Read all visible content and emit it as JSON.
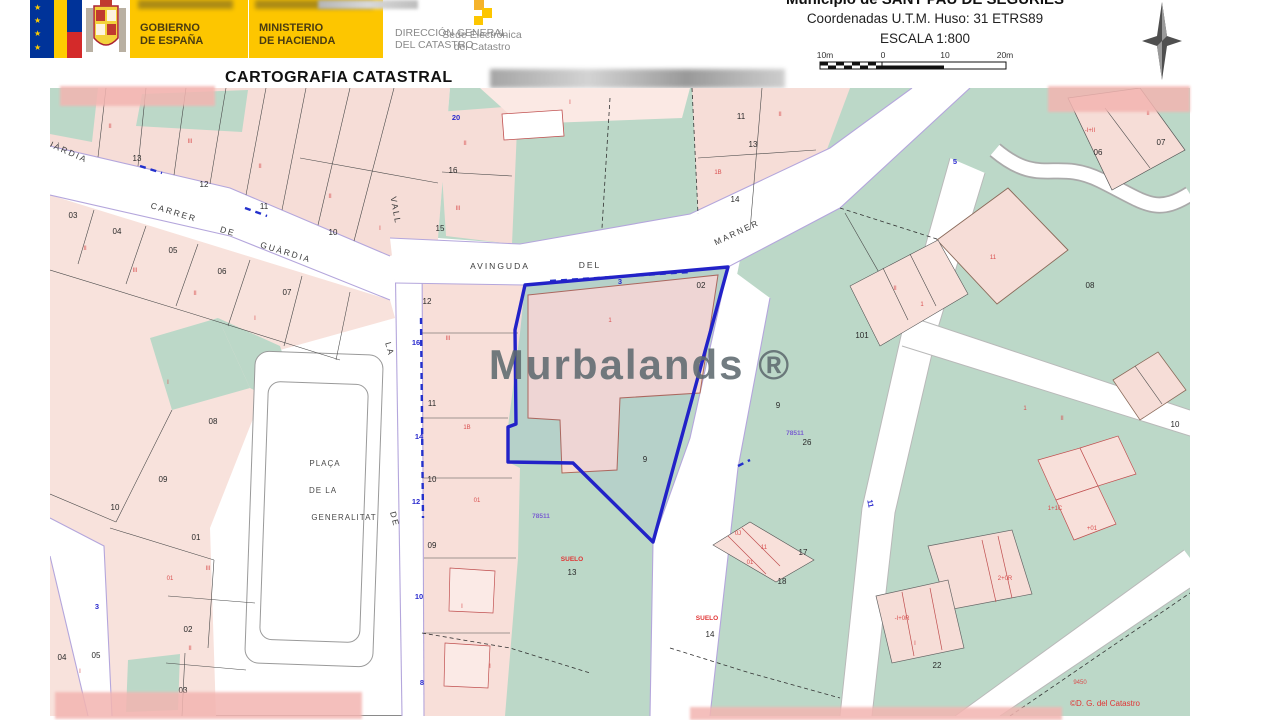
{
  "header": {
    "gobierno_1": "GOBIERNO",
    "gobierno_2": "DE ESPAÑA",
    "ministerio_1": "MINISTERIO",
    "ministerio_2": "DE HACIENDA",
    "direccion_1": "DIRECCIÓN GENERAL",
    "direccion_2": "DEL CATASTRO",
    "sede_1": "Sede Electrónica",
    "sede_2": "del Catastro",
    "municipio": "Municipio de SANT PAU DE SEGURIES",
    "coordenadas": "Coordenadas U.T.M. Huso: 31 ETRS89",
    "escala": "ESCALA 1:800",
    "scale_ticks": [
      "10m",
      "0",
      "10",
      "20m"
    ],
    "title": "CARTOGRAFIA CATASTRAL"
  },
  "map": {
    "watermark": "Murbalands ®",
    "labels": [
      {
        "t": "CARRER",
        "x": 123,
        "y": 127,
        "k": "s",
        "r": 17
      },
      {
        "t": "DE",
        "x": 177,
        "y": 146,
        "k": "s",
        "r": 17
      },
      {
        "t": "GUÀRDIA",
        "x": 235,
        "y": 167,
        "k": "s",
        "r": 17
      },
      {
        "t": "UÀRDIA",
        "x": 16,
        "y": 66,
        "k": "s",
        "r": 24
      },
      {
        "t": "AVINGUDA",
        "x": 450,
        "y": 181,
        "k": "s",
        "r": 0
      },
      {
        "t": "DEL",
        "x": 540,
        "y": 180,
        "k": "s",
        "r": 0
      },
      {
        "t": "MARNER",
        "x": 688,
        "y": 147,
        "k": "s",
        "r": -25
      },
      {
        "t": "VALL",
        "x": 343,
        "y": 123,
        "k": "s",
        "r": 80
      },
      {
        "t": "LA",
        "x": 337,
        "y": 262,
        "k": "s",
        "r": 75
      },
      {
        "t": "DE",
        "x": 342,
        "y": 432,
        "k": "s",
        "r": 75
      },
      {
        "t": "PLAÇA",
        "x": 275,
        "y": 378,
        "k": "z"
      },
      {
        "t": "DE LA",
        "x": 273,
        "y": 405,
        "k": "z"
      },
      {
        "t": "GENERALITAT",
        "x": 294,
        "y": 432,
        "k": "z"
      },
      {
        "t": "13",
        "x": 87,
        "y": 73,
        "k": "p"
      },
      {
        "t": "12",
        "x": 154,
        "y": 99,
        "k": "p"
      },
      {
        "t": "11",
        "x": 214,
        "y": 121,
        "k": "p"
      },
      {
        "t": "10",
        "x": 283,
        "y": 147,
        "k": "p"
      },
      {
        "t": "03",
        "x": 23,
        "y": 130,
        "k": "p"
      },
      {
        "t": "04",
        "x": 67,
        "y": 146,
        "k": "p"
      },
      {
        "t": "05",
        "x": 123,
        "y": 165,
        "k": "p"
      },
      {
        "t": "06",
        "x": 172,
        "y": 186,
        "k": "p"
      },
      {
        "t": "07",
        "x": 237,
        "y": 207,
        "k": "p"
      },
      {
        "t": "08",
        "x": 163,
        "y": 336,
        "k": "p"
      },
      {
        "t": "09",
        "x": 113,
        "y": 394,
        "k": "p"
      },
      {
        "t": "10",
        "x": 65,
        "y": 422,
        "k": "p"
      },
      {
        "t": "01",
        "x": 146,
        "y": 452,
        "k": "p"
      },
      {
        "t": "02",
        "x": 138,
        "y": 544,
        "k": "p"
      },
      {
        "t": "03",
        "x": 133,
        "y": 605,
        "k": "p"
      },
      {
        "t": "04",
        "x": 12,
        "y": 572,
        "k": "p"
      },
      {
        "t": "05",
        "x": 46,
        "y": 570,
        "k": "p"
      },
      {
        "t": "16",
        "x": 403,
        "y": 85,
        "k": "p"
      },
      {
        "t": "15",
        "x": 390,
        "y": 143,
        "k": "p"
      },
      {
        "t": "11",
        "x": 691,
        "y": 31,
        "k": "p"
      },
      {
        "t": "13",
        "x": 703,
        "y": 59,
        "k": "p"
      },
      {
        "t": "14",
        "x": 685,
        "y": 114,
        "k": "p"
      },
      {
        "t": "02",
        "x": 651,
        "y": 200,
        "k": "p"
      },
      {
        "t": "12",
        "x": 377,
        "y": 216,
        "k": "p"
      },
      {
        "t": "11",
        "x": 382,
        "y": 318,
        "k": "p"
      },
      {
        "t": "10",
        "x": 382,
        "y": 394,
        "k": "p"
      },
      {
        "t": "09",
        "x": 382,
        "y": 460,
        "k": "p"
      },
      {
        "t": "13",
        "x": 522,
        "y": 487,
        "k": "p"
      },
      {
        "t": "14",
        "x": 660,
        "y": 549,
        "k": "p"
      },
      {
        "t": "17",
        "x": 753,
        "y": 467,
        "k": "p"
      },
      {
        "t": "18",
        "x": 732,
        "y": 496,
        "k": "p"
      },
      {
        "t": "26",
        "x": 757,
        "y": 357,
        "k": "p"
      },
      {
        "t": "22",
        "x": 887,
        "y": 580,
        "k": "p"
      },
      {
        "t": "06",
        "x": 1048,
        "y": 67,
        "k": "p"
      },
      {
        "t": "07",
        "x": 1111,
        "y": 57,
        "k": "p"
      },
      {
        "t": "08",
        "x": 1040,
        "y": 200,
        "k": "p"
      },
      {
        "t": "10",
        "x": 1125,
        "y": 339,
        "k": "p"
      },
      {
        "t": "101",
        "x": 812,
        "y": 250,
        "k": "p"
      },
      {
        "t": "9",
        "x": 595,
        "y": 374,
        "k": "p"
      },
      {
        "t": "9",
        "x": 728,
        "y": 320,
        "k": "p"
      },
      {
        "t": "II",
        "x": 60,
        "y": 40,
        "k": "c"
      },
      {
        "t": "III",
        "x": 140,
        "y": 55,
        "k": "c"
      },
      {
        "t": "II",
        "x": 210,
        "y": 80,
        "k": "c"
      },
      {
        "t": "II",
        "x": 280,
        "y": 110,
        "k": "c"
      },
      {
        "t": "I",
        "x": 330,
        "y": 142,
        "k": "c"
      },
      {
        "t": "II",
        "x": 35,
        "y": 162,
        "k": "c"
      },
      {
        "t": "III",
        "x": 85,
        "y": 184,
        "k": "c"
      },
      {
        "t": "II",
        "x": 145,
        "y": 207,
        "k": "c"
      },
      {
        "t": "I",
        "x": 205,
        "y": 232,
        "k": "c"
      },
      {
        "t": "I",
        "x": 118,
        "y": 296,
        "k": "c"
      },
      {
        "t": "01",
        "x": 120,
        "y": 492,
        "k": "c"
      },
      {
        "t": "III",
        "x": 158,
        "y": 482,
        "k": "c"
      },
      {
        "t": "II",
        "x": 140,
        "y": 562,
        "k": "c"
      },
      {
        "t": "I",
        "x": 30,
        "y": 585,
        "k": "c"
      },
      {
        "t": "II",
        "x": 415,
        "y": 57,
        "k": "c"
      },
      {
        "t": "III",
        "x": 408,
        "y": 122,
        "k": "c"
      },
      {
        "t": "I",
        "x": 520,
        "y": 16,
        "k": "c"
      },
      {
        "t": "1B",
        "x": 668,
        "y": 86,
        "k": "c"
      },
      {
        "t": "II",
        "x": 730,
        "y": 28,
        "k": "c"
      },
      {
        "t": "III",
        "x": 398,
        "y": 252,
        "k": "c"
      },
      {
        "t": "1B",
        "x": 417,
        "y": 341,
        "k": "c"
      },
      {
        "t": "01",
        "x": 427,
        "y": 414,
        "k": "c"
      },
      {
        "t": "I",
        "x": 412,
        "y": 520,
        "k": "c"
      },
      {
        "t": "I",
        "x": 440,
        "y": 580,
        "k": "c"
      },
      {
        "t": "1",
        "x": 560,
        "y": 234,
        "k": "c"
      },
      {
        "t": "II",
        "x": 845,
        "y": 202,
        "k": "c"
      },
      {
        "t": "1",
        "x": 872,
        "y": 218,
        "k": "c"
      },
      {
        "t": "1",
        "x": 975,
        "y": 322,
        "k": "c"
      },
      {
        "t": "II",
        "x": 1012,
        "y": 332,
        "k": "c"
      },
      {
        "t": "11",
        "x": 943,
        "y": 171,
        "k": "c"
      },
      {
        "t": "-I+II",
        "x": 1040,
        "y": 44,
        "k": "c"
      },
      {
        "t": "II",
        "x": 1098,
        "y": 27,
        "k": "c"
      },
      {
        "t": "1+1C",
        "x": 1005,
        "y": 422,
        "k": "c"
      },
      {
        "t": "+01",
        "x": 1042,
        "y": 442,
        "k": "c"
      },
      {
        "t": "2+0R",
        "x": 955,
        "y": 492,
        "k": "c"
      },
      {
        "t": "-I+0R",
        "x": 852,
        "y": 532,
        "k": "c"
      },
      {
        "t": "I",
        "x": 865,
        "y": 557,
        "k": "c"
      },
      {
        "t": "9450",
        "x": 1030,
        "y": 596,
        "k": "c"
      },
      {
        "t": "0J",
        "x": 688,
        "y": 447,
        "k": "c"
      },
      {
        "t": "11",
        "x": 714,
        "y": 461,
        "k": "c"
      },
      {
        "t": "01",
        "x": 700,
        "y": 476,
        "k": "c"
      },
      {
        "t": "SUELO",
        "x": 522,
        "y": 473,
        "k": "u"
      },
      {
        "t": "SUELO",
        "x": 657,
        "y": 532,
        "k": "u"
      },
      {
        "t": "3",
        "x": 570,
        "y": 196,
        "k": "h"
      },
      {
        "t": "20",
        "x": 406,
        "y": 32,
        "k": "h"
      },
      {
        "t": "16",
        "x": 366,
        "y": 257,
        "k": "h"
      },
      {
        "t": "14",
        "x": 369,
        "y": 351,
        "k": "h"
      },
      {
        "t": "12",
        "x": 366,
        "y": 416,
        "k": "h"
      },
      {
        "t": "10",
        "x": 369,
        "y": 511,
        "k": "h"
      },
      {
        "t": "8",
        "x": 372,
        "y": 597,
        "k": "h"
      },
      {
        "t": "3",
        "x": 47,
        "y": 521,
        "k": "h"
      },
      {
        "t": "11",
        "x": 818,
        "y": 416,
        "k": "h",
        "r": 80
      },
      {
        "t": "5",
        "x": 905,
        "y": 76,
        "k": "h"
      },
      {
        "t": "78511",
        "x": 491,
        "y": 430,
        "k": "m"
      },
      {
        "t": "78511",
        "x": 745,
        "y": 347,
        "k": "m"
      },
      {
        "t": "©D. G. del Catastro",
        "x": 1055,
        "y": 618,
        "k": "cr"
      }
    ]
  },
  "colors": {
    "accent_yellow": "#fdc600",
    "parcel_pink": "#f6ddd7",
    "parcel_green": "#bcd8c8",
    "street_purple": "#b4a6dc",
    "selected_blue": "#2222c8",
    "code_red": "#d94f4f",
    "mass_purple": "#7a5fd0",
    "watermark_gray": "#5f6b70",
    "redaction_pink": "#f3b5b1"
  }
}
